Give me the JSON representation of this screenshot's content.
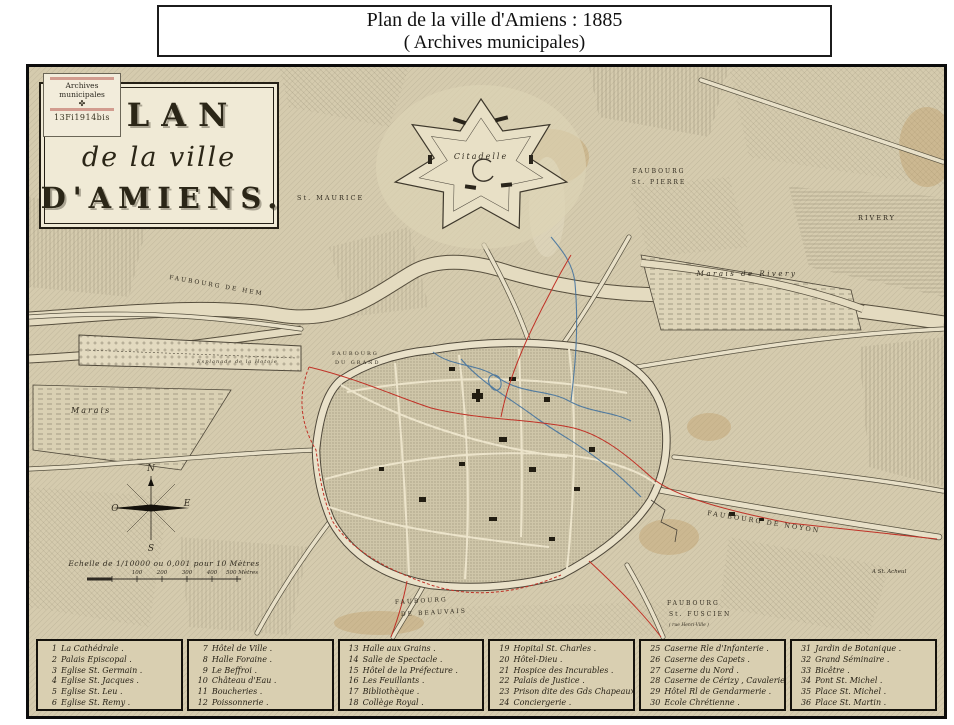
{
  "banner": {
    "line1": "Plan de la ville d'Amiens : 1885",
    "line2": "( Archives municipales)"
  },
  "stamp": {
    "title": "Archives municipales",
    "symbol": "✤",
    "code": "13Fi1914bis"
  },
  "cartouche": {
    "line1": "PLAN",
    "line2": "de la ville",
    "line3": "D'AMIENS."
  },
  "map_labels": {
    "citadelle": "Citadelle",
    "st_maurice": "St. MAURICE",
    "faubourg_st_pierre_1": "FAUBOURG",
    "faubourg_st_pierre_2": "St. PIERRE",
    "rivery": "RIVERY",
    "marais_de_rivery": "Marais de Rivery",
    "faubourg_de_hem": "FAUBOURG DE HEM",
    "esplanade_hotoie": "Esplanade de la Hotoie",
    "faubourg_du_grand_1": "FAUBOURG",
    "faubourg_du_grand_2": "DU GRAND",
    "marais": "Marais",
    "faubourg_de_noyon": "FAUBOURG DE NOYON",
    "st_acheul": "A St. Acheul",
    "faubourg_st_fuscien_1": "FAUBOURG",
    "faubourg_st_fuscien_2": "St. FUSCIEN",
    "faubourg_st_fuscien_3": "( rue Henri-Ville )",
    "faubourg_beauvais_1": "FAUBOURG",
    "faubourg_beauvais_2": "DE BEAUVAIS"
  },
  "compass": {
    "n": "N",
    "e": "E",
    "s": "S",
    "o": "O"
  },
  "scale": {
    "caption": "Echelle de 1/10000 ou 0,001 pour 10 Mètres",
    "ticks": [
      "100",
      "200",
      "300",
      "400",
      "500 Mètres"
    ]
  },
  "legend": {
    "columns": [
      {
        "items": [
          {
            "num": "1",
            "label": "La Cathédrale ."
          },
          {
            "num": "2",
            "label": "Palais Episcopal ."
          },
          {
            "num": "3",
            "label": "Eglise St. Germain ."
          },
          {
            "num": "4",
            "label": "Eglise St. Jacques ."
          },
          {
            "num": "5",
            "label": "Eglise St. Leu ."
          },
          {
            "num": "6",
            "label": "Eglise St. Remy ."
          }
        ]
      },
      {
        "items": [
          {
            "num": "7",
            "label": "Hôtel de Ville ."
          },
          {
            "num": "8",
            "label": "Halle Foraine ."
          },
          {
            "num": "9",
            "label": "Le Beffroi ."
          },
          {
            "num": "10",
            "label": "Château d'Eau ."
          },
          {
            "num": "11",
            "label": "Boucheries ."
          },
          {
            "num": "12",
            "label": "Poissonnerie ."
          }
        ]
      },
      {
        "items": [
          {
            "num": "13",
            "label": "Halle aux Grains ."
          },
          {
            "num": "14",
            "label": "Salle de Spectacle ."
          },
          {
            "num": "15",
            "label": "Hôtel de la Préfecture ."
          },
          {
            "num": "16",
            "label": "Les Feuillants ."
          },
          {
            "num": "17",
            "label": "Bibliothèque ."
          },
          {
            "num": "18",
            "label": "Collège Royal ."
          }
        ]
      },
      {
        "items": [
          {
            "num": "19",
            "label": "Hopital St. Charles ."
          },
          {
            "num": "20",
            "label": "Hôtel-Dieu ."
          },
          {
            "num": "21",
            "label": "Hospice des Incurables ."
          },
          {
            "num": "22",
            "label": "Palais de Justice ."
          },
          {
            "num": "23",
            "label": "Prison dite des Gds Chapeaux ."
          },
          {
            "num": "24",
            "label": "Conciergerie ."
          }
        ]
      },
      {
        "items": [
          {
            "num": "25",
            "label": "Caserne Rle d'Infanterie ."
          },
          {
            "num": "26",
            "label": "Caserne des Capets ."
          },
          {
            "num": "27",
            "label": "Caserne du Nord ."
          },
          {
            "num": "28",
            "label": "Caserne de Cérizy , Cavalerie ."
          },
          {
            "num": "29",
            "label": "Hôtel Rl de Gendarmerie ."
          },
          {
            "num": "30",
            "label": "Ecole Chrétienne ."
          }
        ]
      },
      {
        "items": [
          {
            "num": "31",
            "label": "Jardin de Botanique ."
          },
          {
            "num": "32",
            "label": "Grand Séminaire ."
          },
          {
            "num": "33",
            "label": "Bicêtre ."
          },
          {
            "num": "34",
            "label": "Pont St. Michel ."
          },
          {
            "num": "35",
            "label": "Place St. Michel ."
          },
          {
            "num": "36",
            "label": "Place St. Martin ."
          }
        ]
      }
    ]
  },
  "colors": {
    "parchment": "#d5cbae",
    "ink": "#3a342a",
    "route_red": "#c03227",
    "water_blue": "#46749f",
    "cream": "#f0ead6"
  }
}
